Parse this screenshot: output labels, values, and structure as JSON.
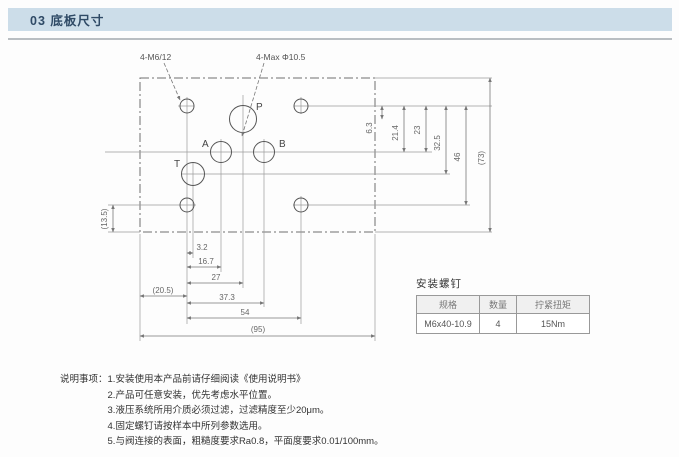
{
  "header": {
    "title": "03 底板尺寸"
  },
  "drawing": {
    "callouts": {
      "mounting_holes": "4-M6/12",
      "max_ports": "4-Max Φ10.5"
    },
    "ports": {
      "p": "P",
      "a": "A",
      "b": "B",
      "t": "T"
    },
    "dims": {
      "bottom": {
        "v1": "3.2",
        "v2": "16.7",
        "v3": "27",
        "v4": "(20.5)",
        "v5": "37.3",
        "v6": "54",
        "v7": "(95)"
      },
      "right": {
        "v1": "6.3",
        "v2": "21.4",
        "v3": "23",
        "v4": "32.5",
        "v5": "46",
        "v6": "(73)"
      },
      "left": {
        "v1": "(13.5)"
      }
    }
  },
  "screw_table": {
    "title": "安装螺钉",
    "headers": [
      "规格",
      "数量",
      "拧紧扭矩"
    ],
    "row": [
      "M6x40-10.9",
      "4",
      "15Nm"
    ]
  },
  "notes": {
    "label": "说明事项：",
    "items": [
      "1.安装使用本产品前请仔细阅读《使用说明书》",
      "2.产品可任意安装，优先考虑水平位置。",
      "3.液压系统所用介质必须过滤，过滤精度至少20μm。",
      "4.固定螺钉请按样本中所列参数选用。",
      "5.与阀连接的表面，粗糙度要求Ra0.8，平面度要求0.01/100mm。"
    ]
  },
  "colors": {
    "header_bg": "#ccdde9",
    "header_text": "#2f4a66",
    "line": "#8a8a8a",
    "dim_text": "#666666"
  }
}
